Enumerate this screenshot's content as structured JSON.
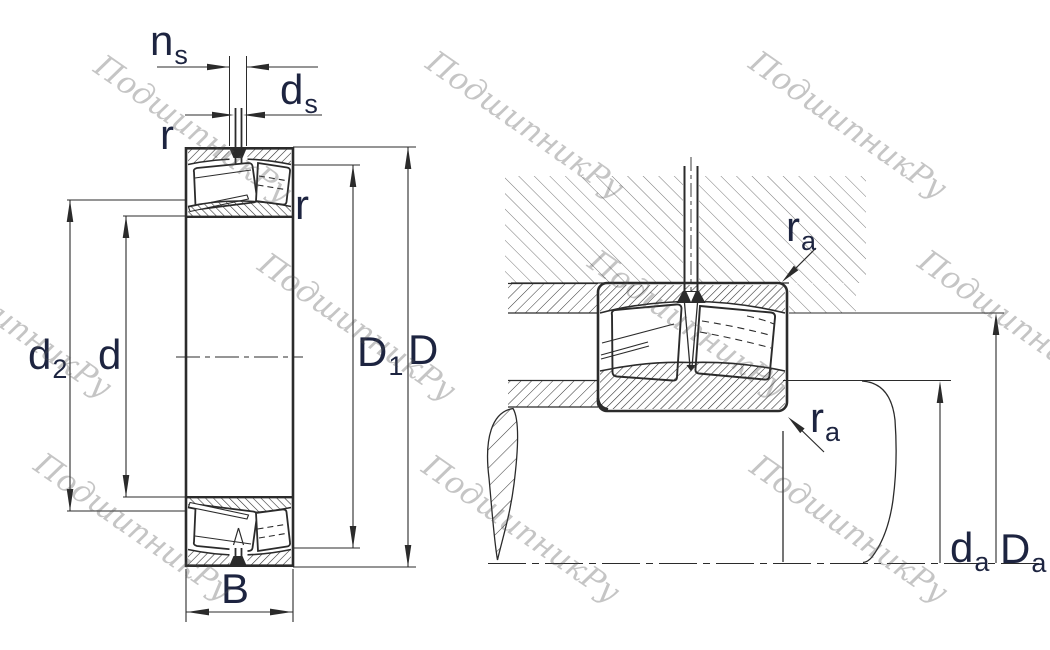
{
  "watermark": {
    "text": "ПодшипникРу"
  },
  "figure": {
    "description": "Spherical roller bearing cross-section with boundary dimensions (left) and mounting / abutment dimensions (right)",
    "colors": {
      "line": "#2b2b2b",
      "label": "#1d2440",
      "housing_hatch": "#787878",
      "watermark_gray": "#bfbfbf"
    },
    "left_view": {
      "labels": {
        "ns": {
          "base": "n",
          "sub": "s"
        },
        "ds": {
          "base": "d",
          "sub": "s"
        },
        "r_top": {
          "base": "r",
          "sub": ""
        },
        "r_right": {
          "base": "r",
          "sub": ""
        },
        "d2": {
          "base": "d",
          "sub": "2"
        },
        "d": {
          "base": "d",
          "sub": ""
        },
        "D1": {
          "base": "D",
          "sub": "1"
        },
        "D": {
          "base": "D",
          "sub": ""
        },
        "B": {
          "base": "B",
          "sub": ""
        }
      }
    },
    "right_view": {
      "labels": {
        "ra_top": {
          "base": "r",
          "sub": "a"
        },
        "ra_bottom": {
          "base": "r",
          "sub": "a"
        },
        "da": {
          "base": "d",
          "sub": "a"
        },
        "Da": {
          "base": "D",
          "sub": "a"
        }
      }
    }
  }
}
